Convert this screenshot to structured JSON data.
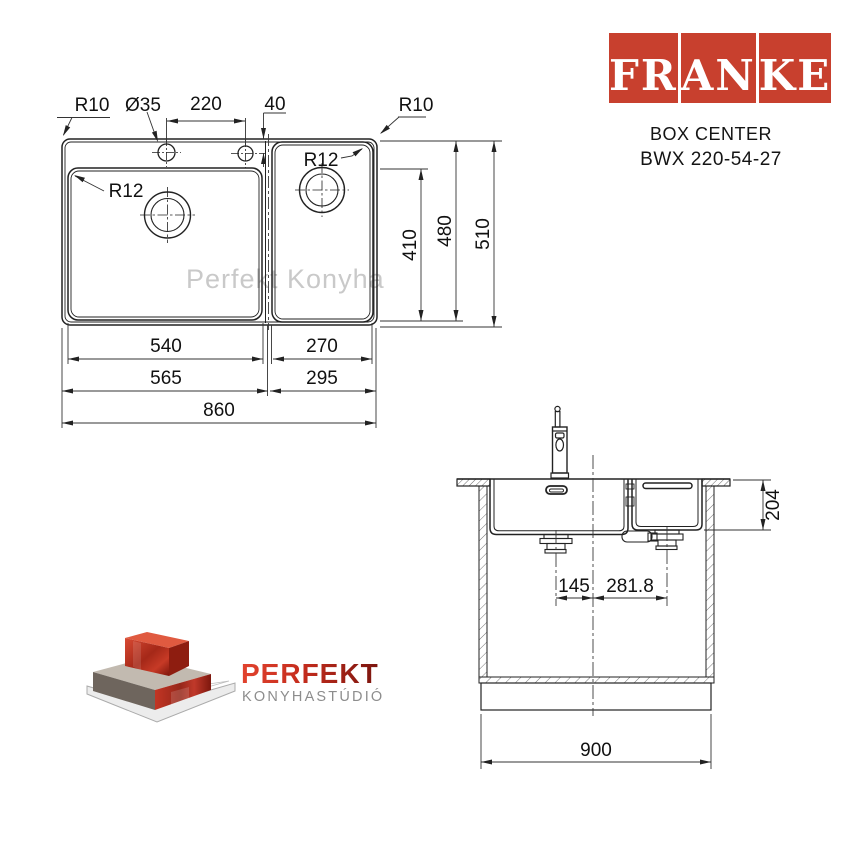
{
  "brand": {
    "logo_blocks": [
      "FR",
      "AN",
      "KE"
    ],
    "logo_color": "#c8402e",
    "model_line1": "BOX CENTER",
    "model_line2": "BWX 220-54-27"
  },
  "watermark": "Perfekt Konyha",
  "top_view": {
    "labels": {
      "corner_radius_left": "R10",
      "hole_diameter": "Ø35",
      "hole_spacing": "220",
      "hole_edge_offset": "40",
      "corner_radius_right": "R10",
      "bowl_radius_main": "R12",
      "bowl_radius_second": "R12"
    },
    "dims": {
      "bowl_main_width": "540",
      "bowl_second_width": "270",
      "section_main_width": "565",
      "section_second_width": "295",
      "total_width": "860",
      "bowl_depth": "410",
      "rim_depth": "480",
      "total_depth": "510"
    }
  },
  "section_view": {
    "dims": {
      "bowl_height": "204",
      "drain_offset_main": "145",
      "drain_offset_second": "281.8",
      "cabinet_width": "900"
    }
  },
  "footer_logo": {
    "name": "PERFEKT",
    "subtitle": "KONYHASTÚDIÓ",
    "name_color_start": "#e2432e",
    "name_color_end": "#7a150e",
    "subtitle_color": "#8d8d8d"
  }
}
